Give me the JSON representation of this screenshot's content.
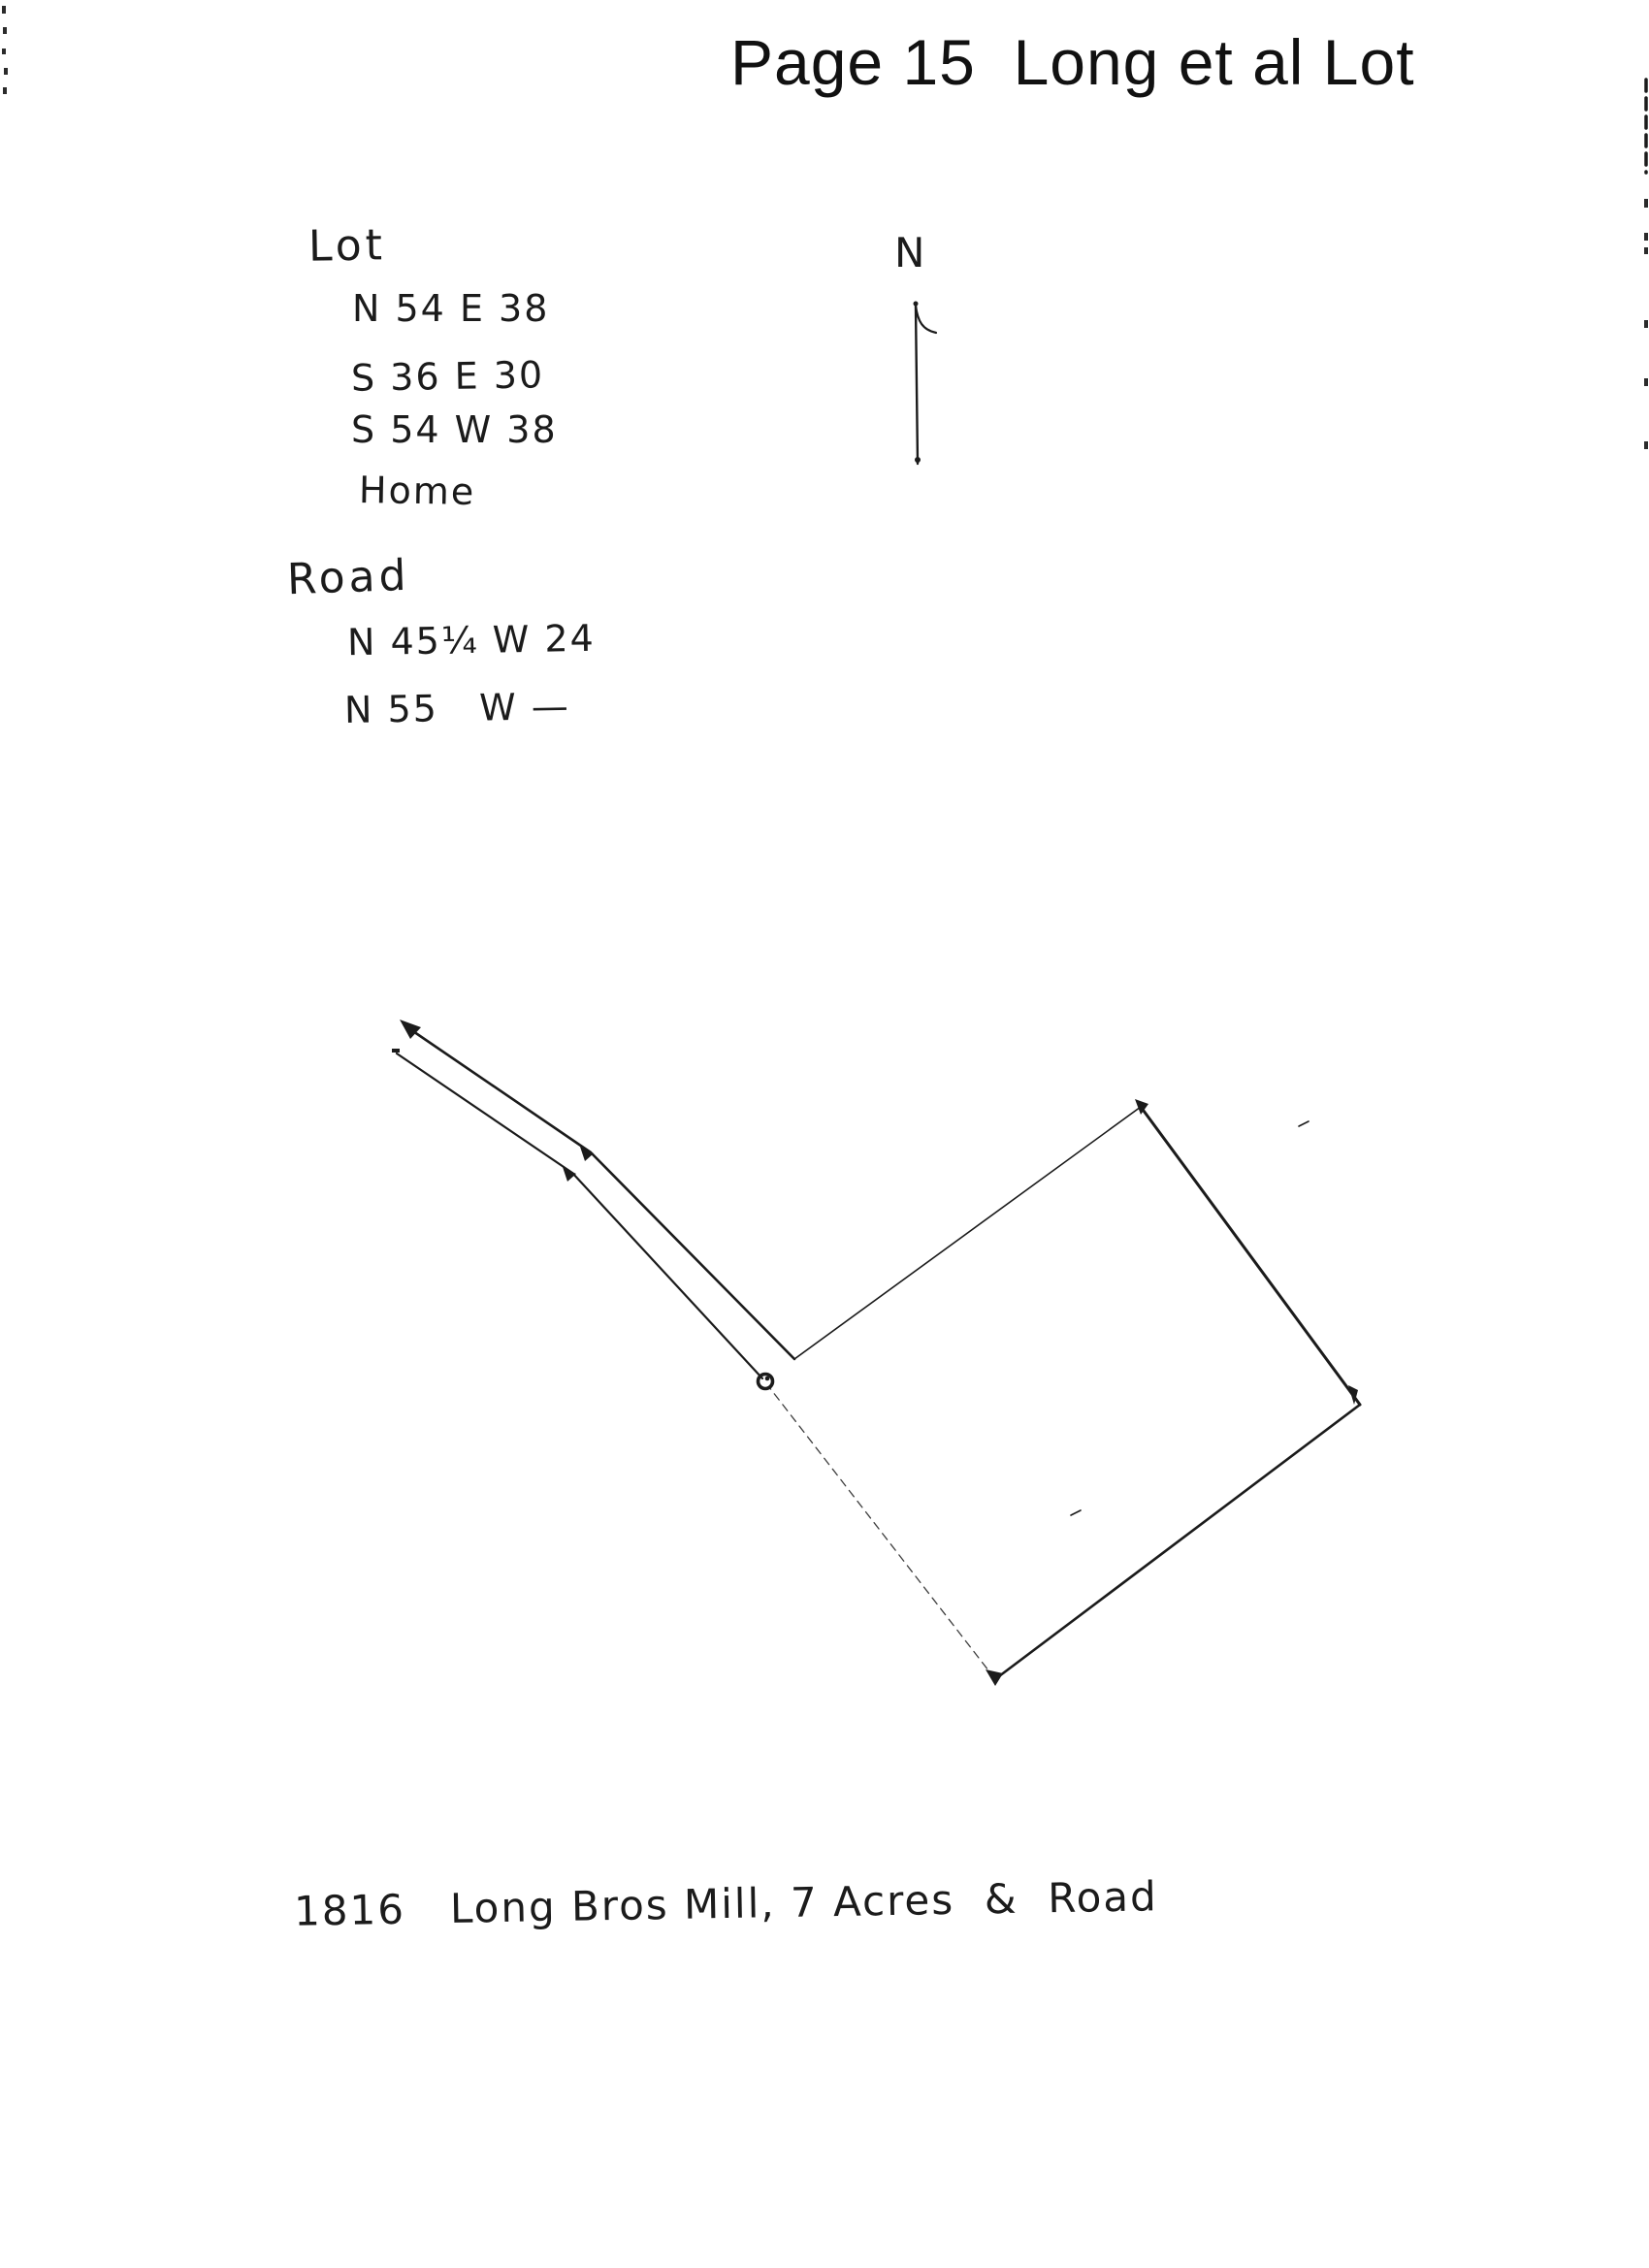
{
  "page": {
    "title": "Page 15  Long et al Lot",
    "caption": "1816   Long Bros Mill, 7 Acres  &  Road"
  },
  "compass": {
    "label": "N"
  },
  "notes": {
    "lot": {
      "heading": "Lot",
      "lines": [
        "N 54 E 38",
        "S 36 E 30",
        "S 54 W 38",
        "Home"
      ]
    },
    "road": {
      "heading": "Road",
      "lines": [
        "N 45¼ W 24",
        "N 55   W —"
      ]
    }
  },
  "sketch": {
    "point_marker": "survey-point-circle",
    "features": [
      "road-double-line",
      "lot-parcel-outline",
      "north-arrow"
    ]
  },
  "colors": {
    "ink": "#1b1b1b",
    "paper": "#ffffff"
  }
}
